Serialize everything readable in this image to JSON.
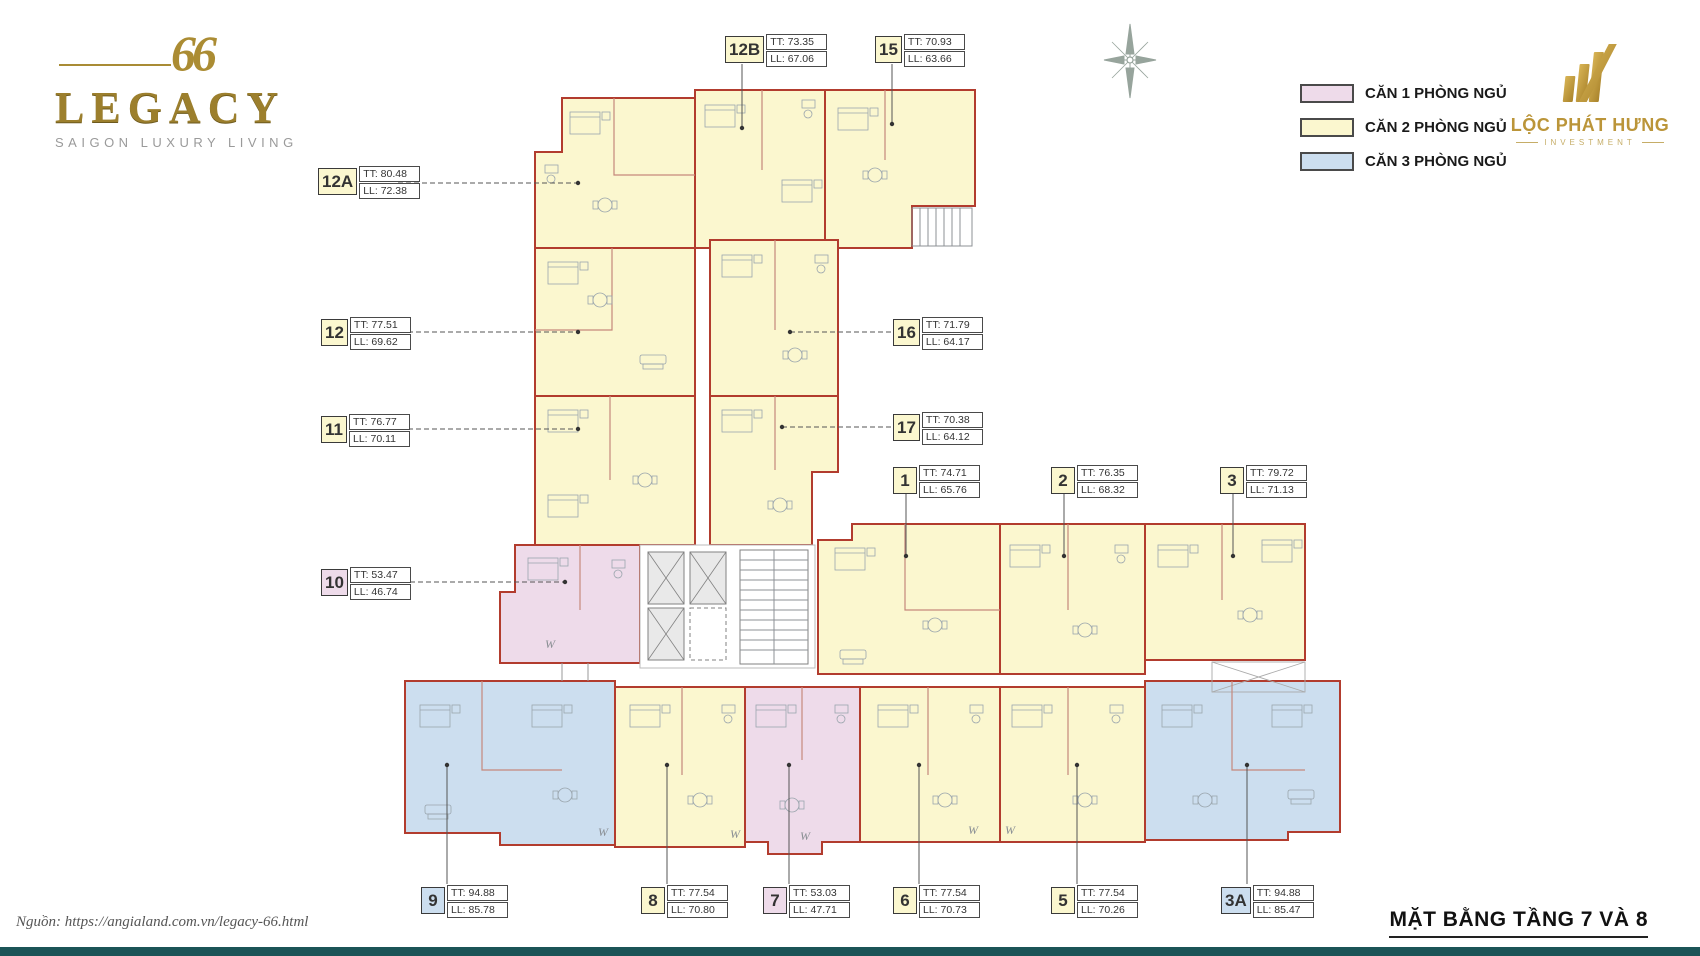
{
  "brand": {
    "mark": "66",
    "name": "LEGACY",
    "tagline": "SAIGON LUXURY LIVING"
  },
  "developer": {
    "name": "LỘC PHÁT HƯNG",
    "subtitle": "INVESTMENT"
  },
  "legend": {
    "items": [
      {
        "label": "CĂN 1 PHÒNG NGỦ",
        "color": "#EEDBEA"
      },
      {
        "label": "CĂN 2 PHÒNG NGỦ",
        "color": "#FBF7CF"
      },
      {
        "label": "CĂN 3 PHÒNG NGỦ",
        "color": "#CCDEEF"
      }
    ]
  },
  "plan": {
    "w_marker": "W",
    "unit_border_color": "#B23C2E"
  },
  "units": [
    {
      "id": "12A",
      "tt": "TT: 80.48",
      "ll": "LL: 72.38",
      "type": "2br"
    },
    {
      "id": "12B",
      "tt": "TT: 73.35",
      "ll": "LL: 67.06",
      "type": "2br"
    },
    {
      "id": "15",
      "tt": "TT: 70.93",
      "ll": "LL: 63.66",
      "type": "2br"
    },
    {
      "id": "12",
      "tt": "TT: 77.51",
      "ll": "LL: 69.62",
      "type": "2br"
    },
    {
      "id": "16",
      "tt": "TT: 71.79",
      "ll": "LL: 64.17",
      "type": "2br"
    },
    {
      "id": "11",
      "tt": "TT: 76.77",
      "ll": "LL: 70.11",
      "type": "2br"
    },
    {
      "id": "17",
      "tt": "TT: 70.38",
      "ll": "LL: 64.12",
      "type": "2br"
    },
    {
      "id": "1",
      "tt": "TT: 74.71",
      "ll": "LL: 65.76",
      "type": "2br"
    },
    {
      "id": "2",
      "tt": "TT: 76.35",
      "ll": "LL: 68.32",
      "type": "2br"
    },
    {
      "id": "3",
      "tt": "TT: 79.72",
      "ll": "LL: 71.13",
      "type": "2br"
    },
    {
      "id": "10",
      "tt": "TT: 53.47",
      "ll": "LL: 46.74",
      "type": "1br"
    },
    {
      "id": "9",
      "tt": "TT: 94.88",
      "ll": "LL: 85.78",
      "type": "3br"
    },
    {
      "id": "8",
      "tt": "TT: 77.54",
      "ll": "LL: 70.80",
      "type": "2br"
    },
    {
      "id": "7",
      "tt": "TT: 53.03",
      "ll": "LL: 47.71",
      "type": "1br"
    },
    {
      "id": "6",
      "tt": "TT: 77.54",
      "ll": "LL: 70.73",
      "type": "2br"
    },
    {
      "id": "5",
      "tt": "TT: 77.54",
      "ll": "LL: 70.26",
      "type": "2br"
    },
    {
      "id": "3A",
      "tt": "TT: 94.88",
      "ll": "LL: 85.47",
      "type": "3br"
    }
  ],
  "footer": {
    "source": "Nguồn:  https://angialand.com.vn/legacy-66.html",
    "title": "MẶT BẰNG TẦNG 7 VÀ 8"
  }
}
